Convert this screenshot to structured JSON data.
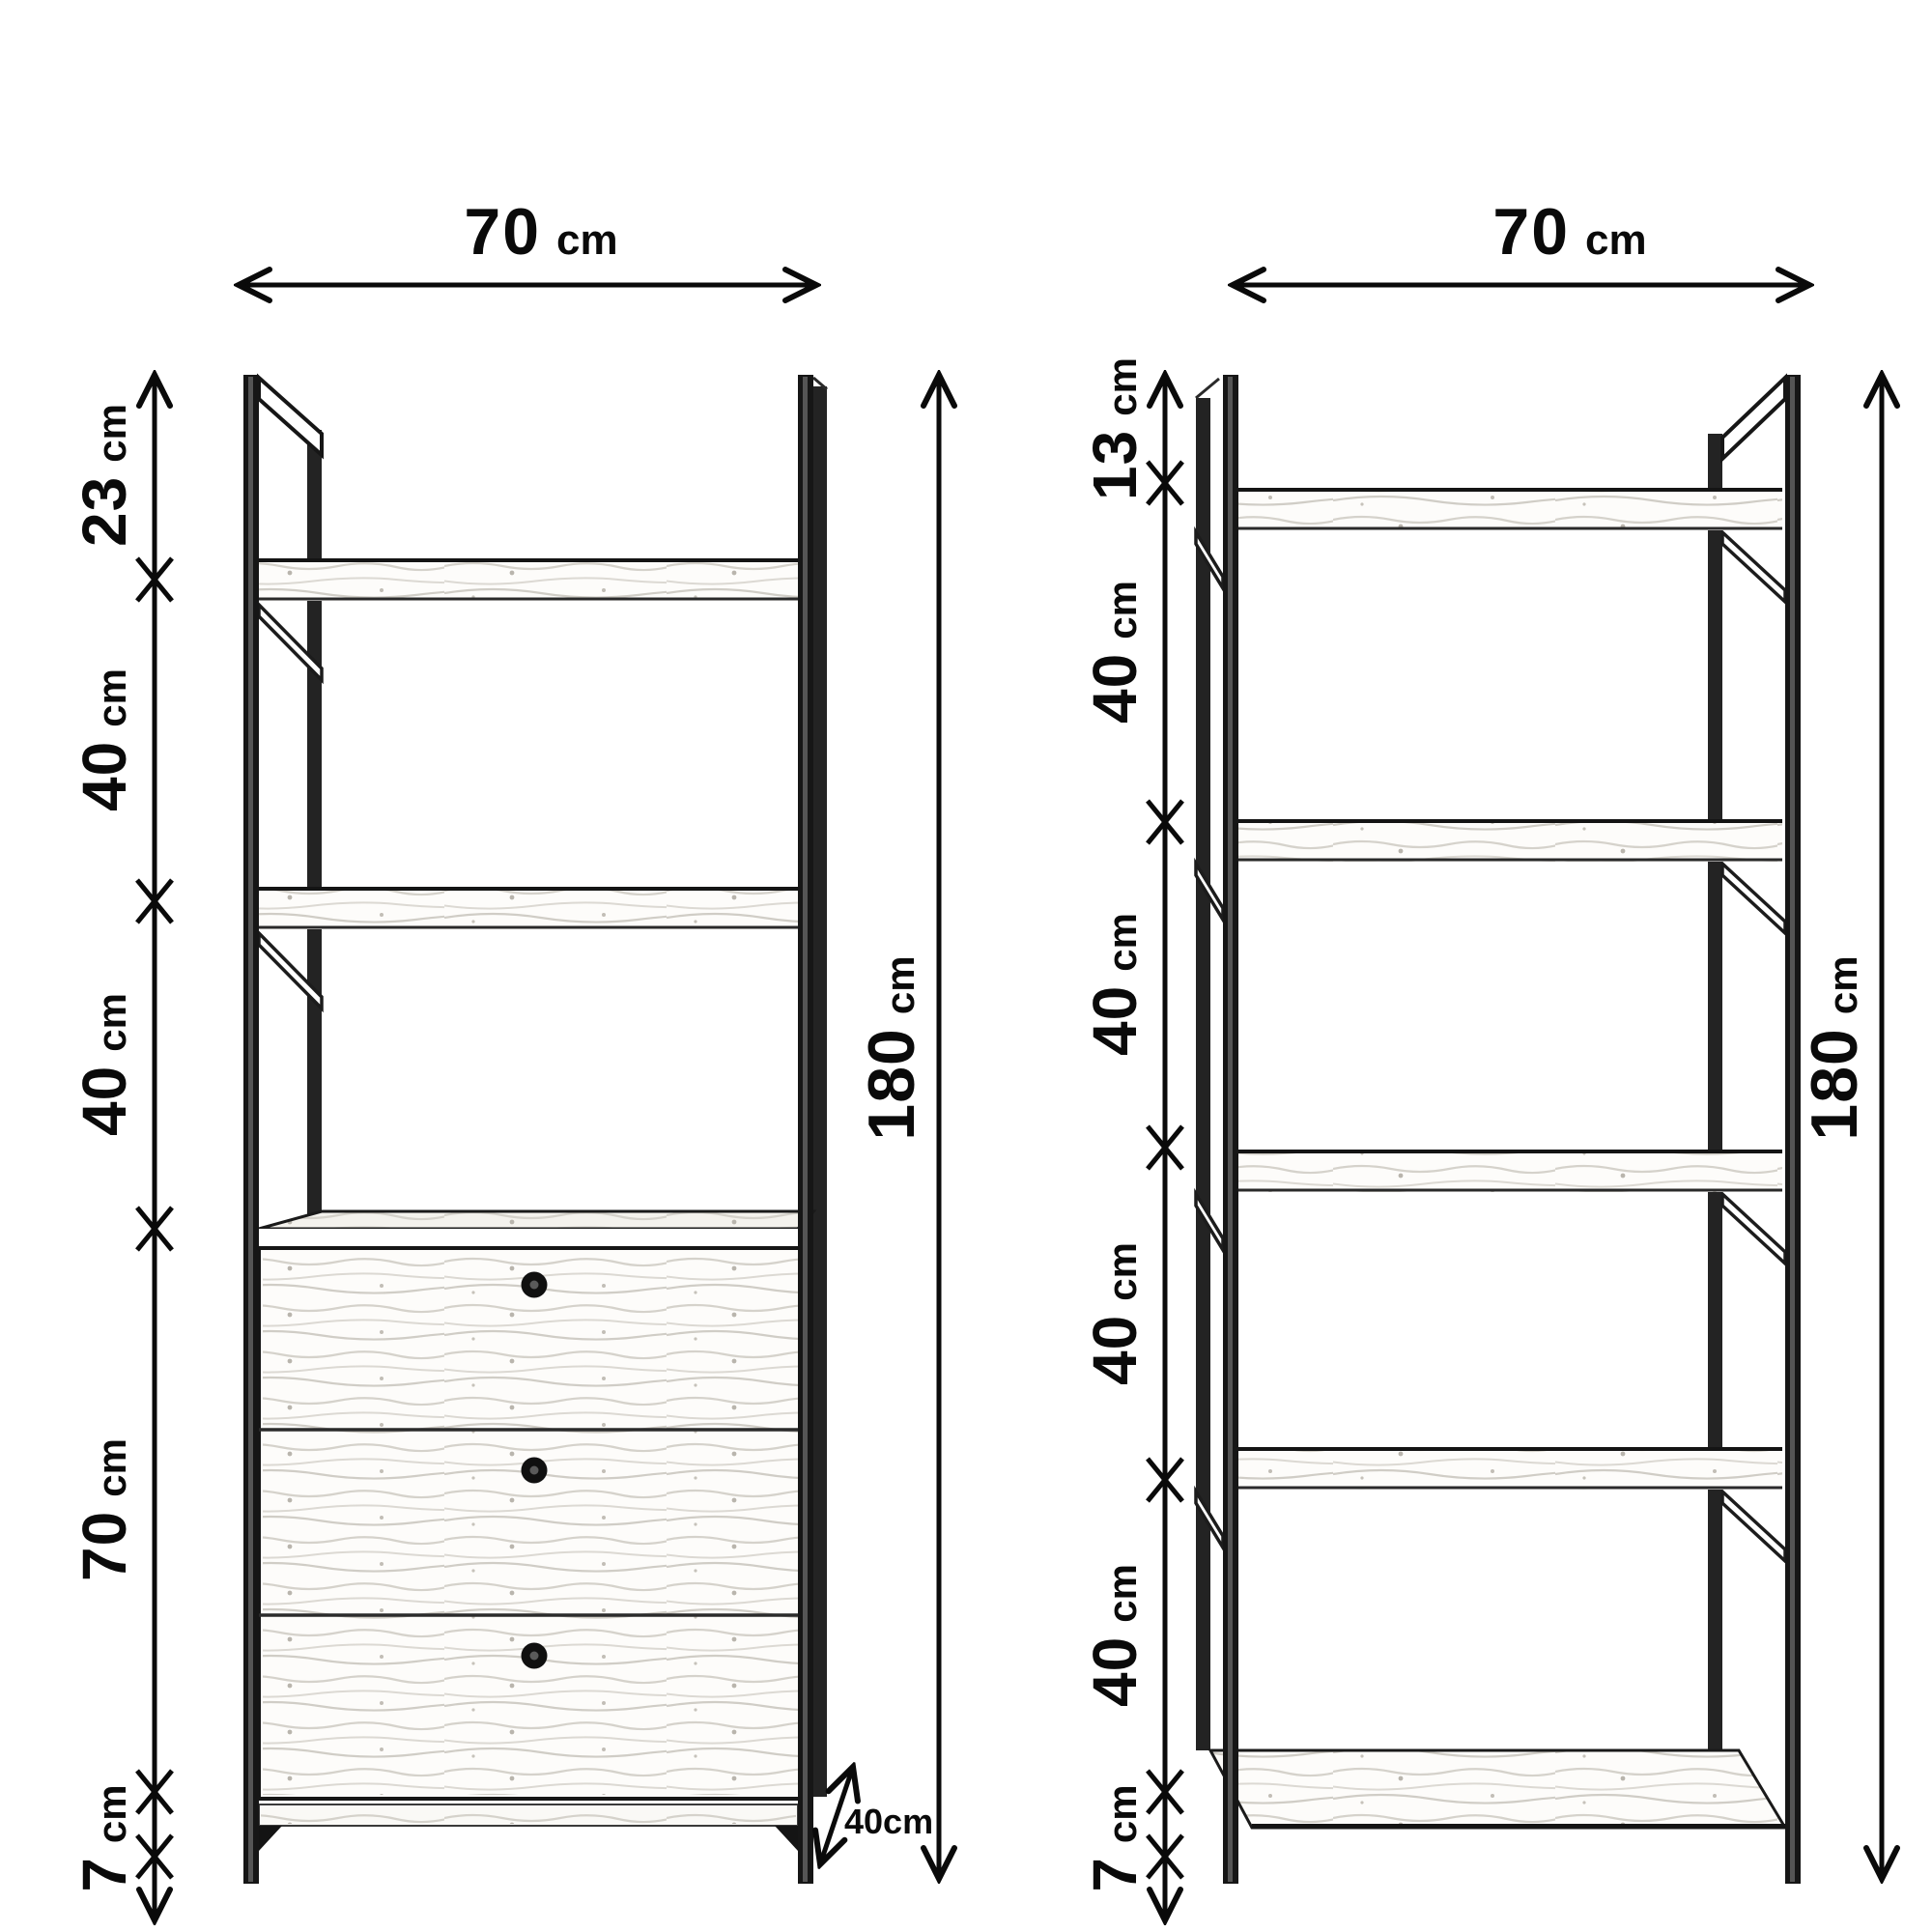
{
  "left_unit": {
    "width": {
      "value": "70",
      "unit": "cm"
    },
    "height": {
      "value": "180",
      "unit": "cm"
    },
    "depth_label": "40cm",
    "sections": [
      {
        "value": "23",
        "unit": "cm"
      },
      {
        "value": "40",
        "unit": "cm"
      },
      {
        "value": "40",
        "unit": "cm"
      },
      {
        "value": "70",
        "unit": "cm"
      },
      {
        "value": "7",
        "unit": "cm"
      }
    ],
    "drawer_count": 3
  },
  "right_unit": {
    "width": {
      "value": "70",
      "unit": "cm"
    },
    "height": {
      "value": "180",
      "unit": "cm"
    },
    "sections": [
      {
        "value": "13",
        "unit": "cm"
      },
      {
        "value": "40",
        "unit": "cm"
      },
      {
        "value": "40",
        "unit": "cm"
      },
      {
        "value": "40",
        "unit": "cm"
      },
      {
        "value": "40",
        "unit": "cm"
      },
      {
        "value": "7",
        "unit": "cm"
      }
    ],
    "shelf_count": 5
  },
  "colors": {
    "ink": "#0a0a0a",
    "metal": "#161616",
    "wood_grain": "#d3d0c9",
    "background": "#ffffff"
  }
}
